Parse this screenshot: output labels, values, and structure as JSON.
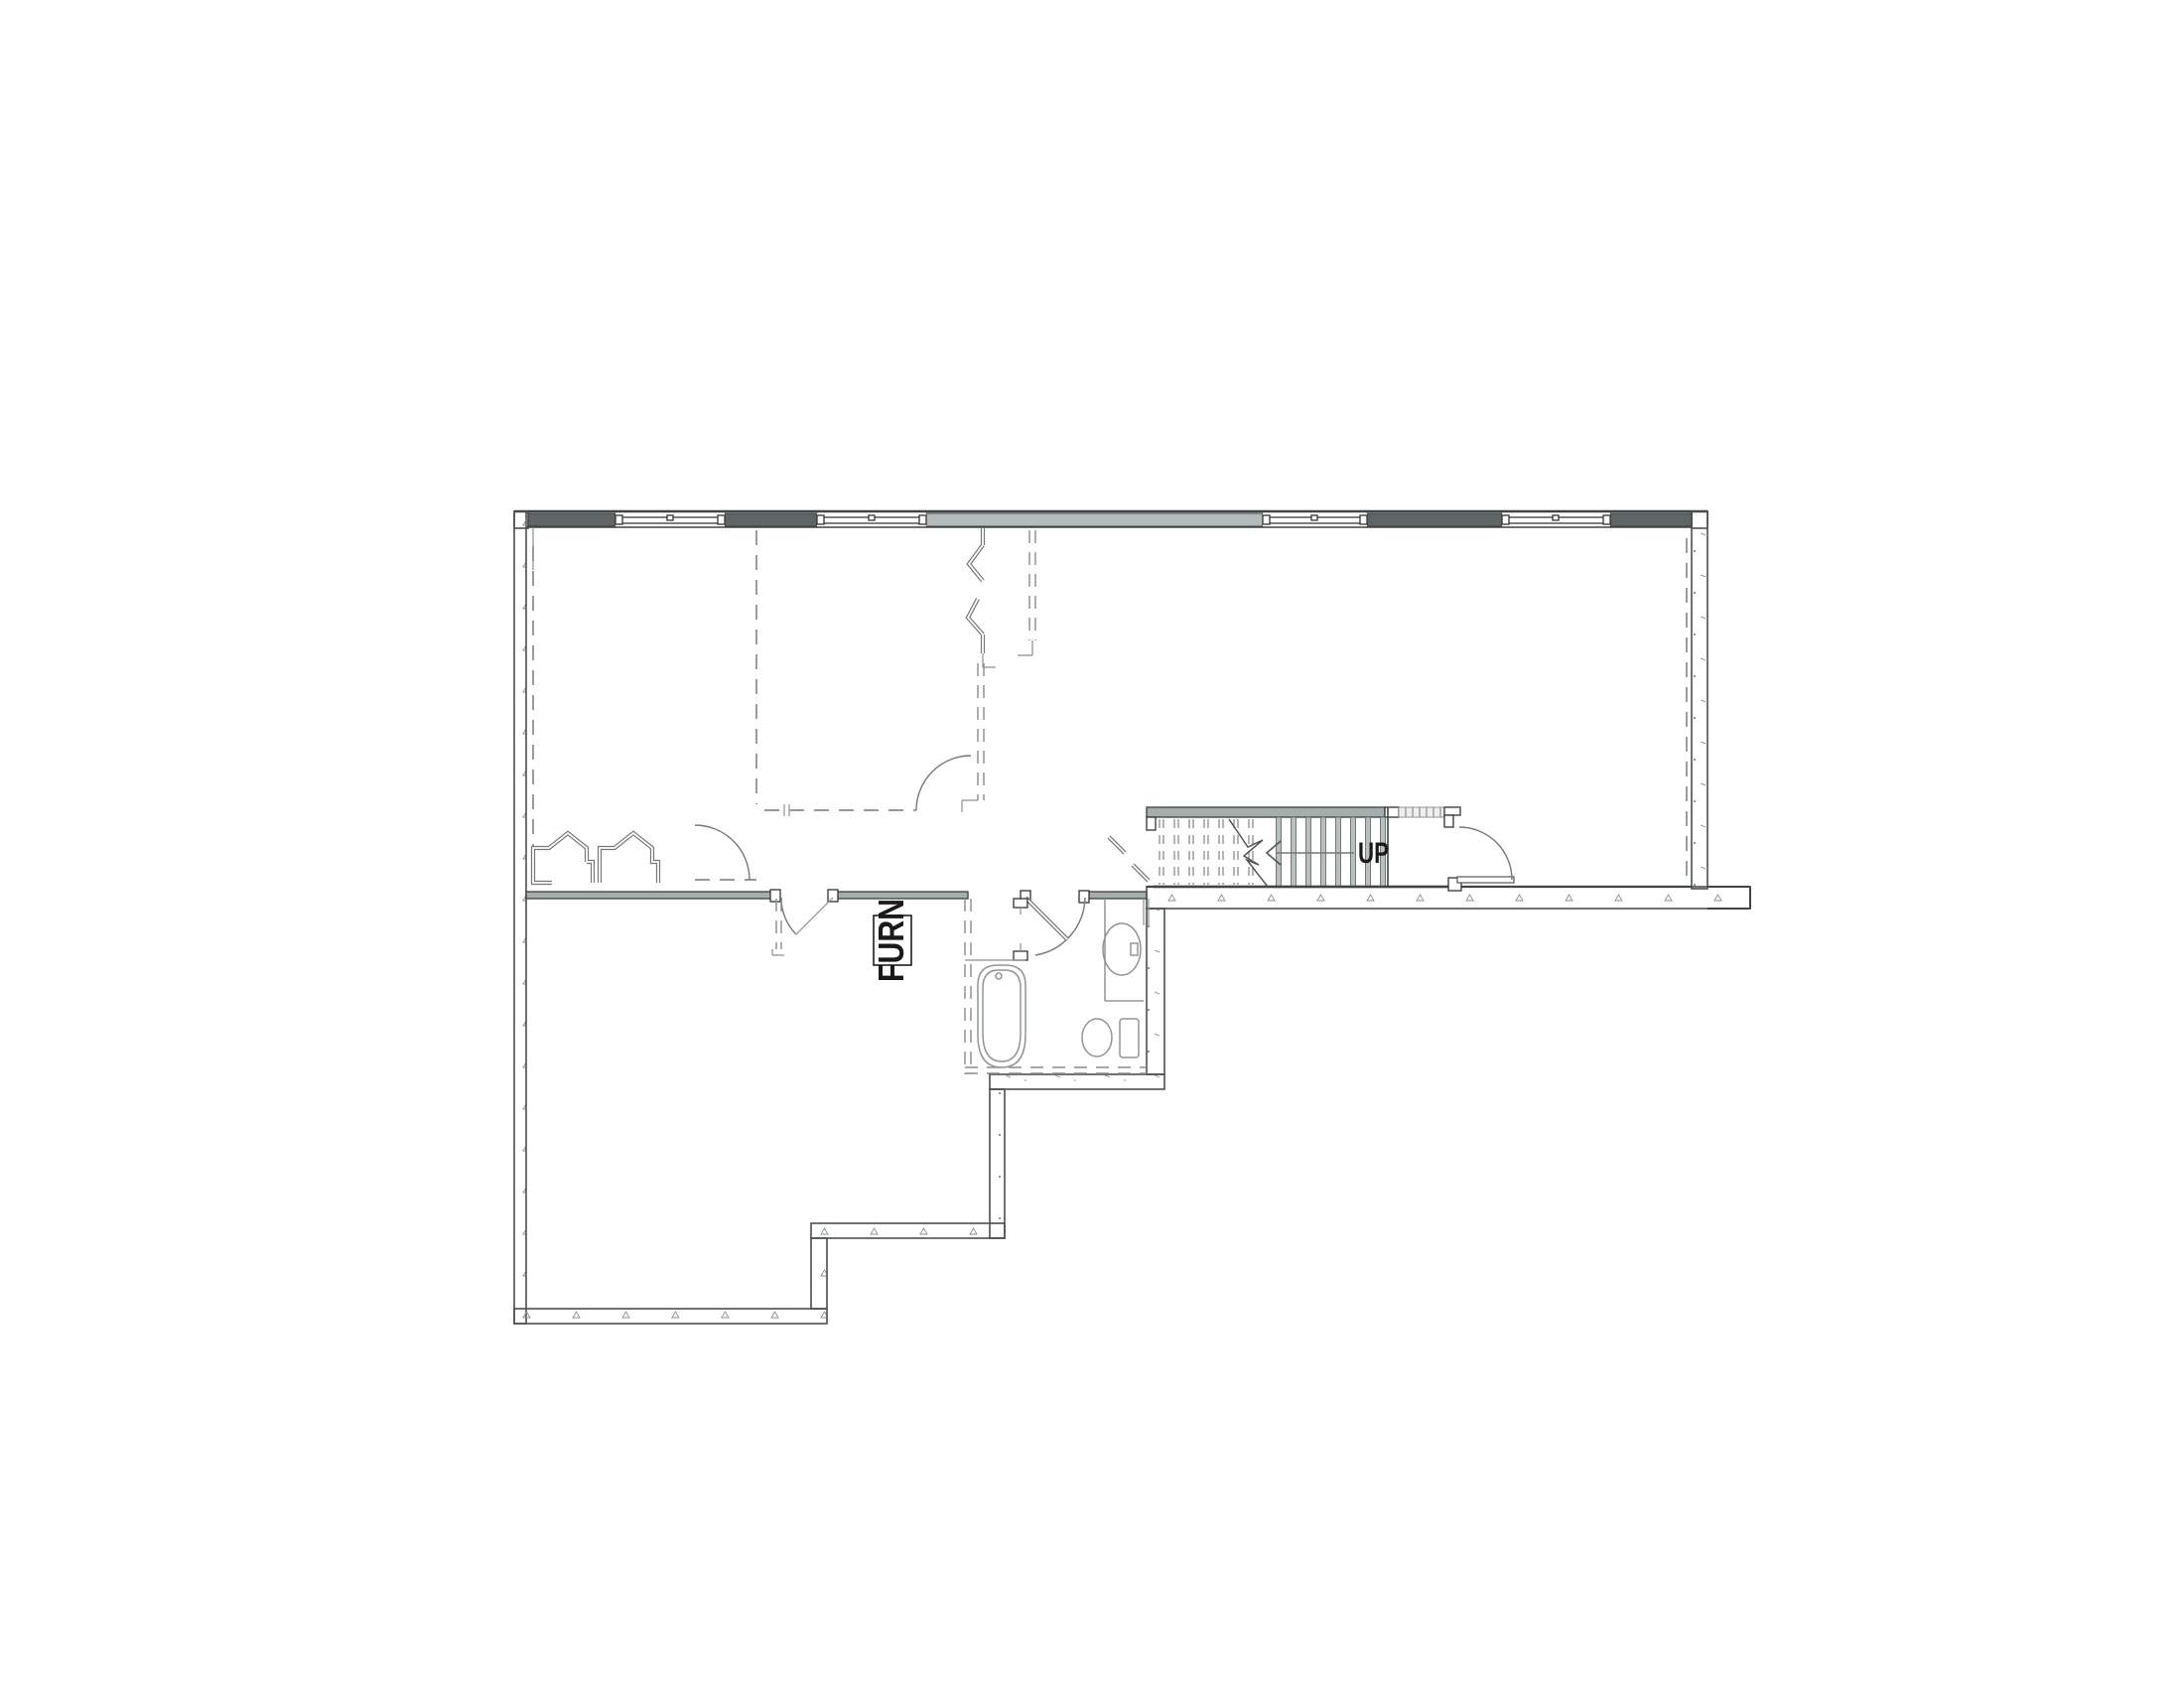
{
  "labels": {
    "stair_direction": "UP",
    "furnace": "FURN"
  },
  "colors": {
    "background": "#ffffff",
    "wall_outline": "#4a4f4f",
    "wall_fill_dark": "#5f6565",
    "wall_fill_light": "#b4bbbb",
    "interior_wall_fill": "#a6adad",
    "stair_wall_fill": "#8e9595",
    "stair_tread_fill": "#b9bfbf",
    "dashed_line": "#8c8c8c",
    "fixture_line": "#8f9595",
    "text": "#1a1a1a"
  }
}
